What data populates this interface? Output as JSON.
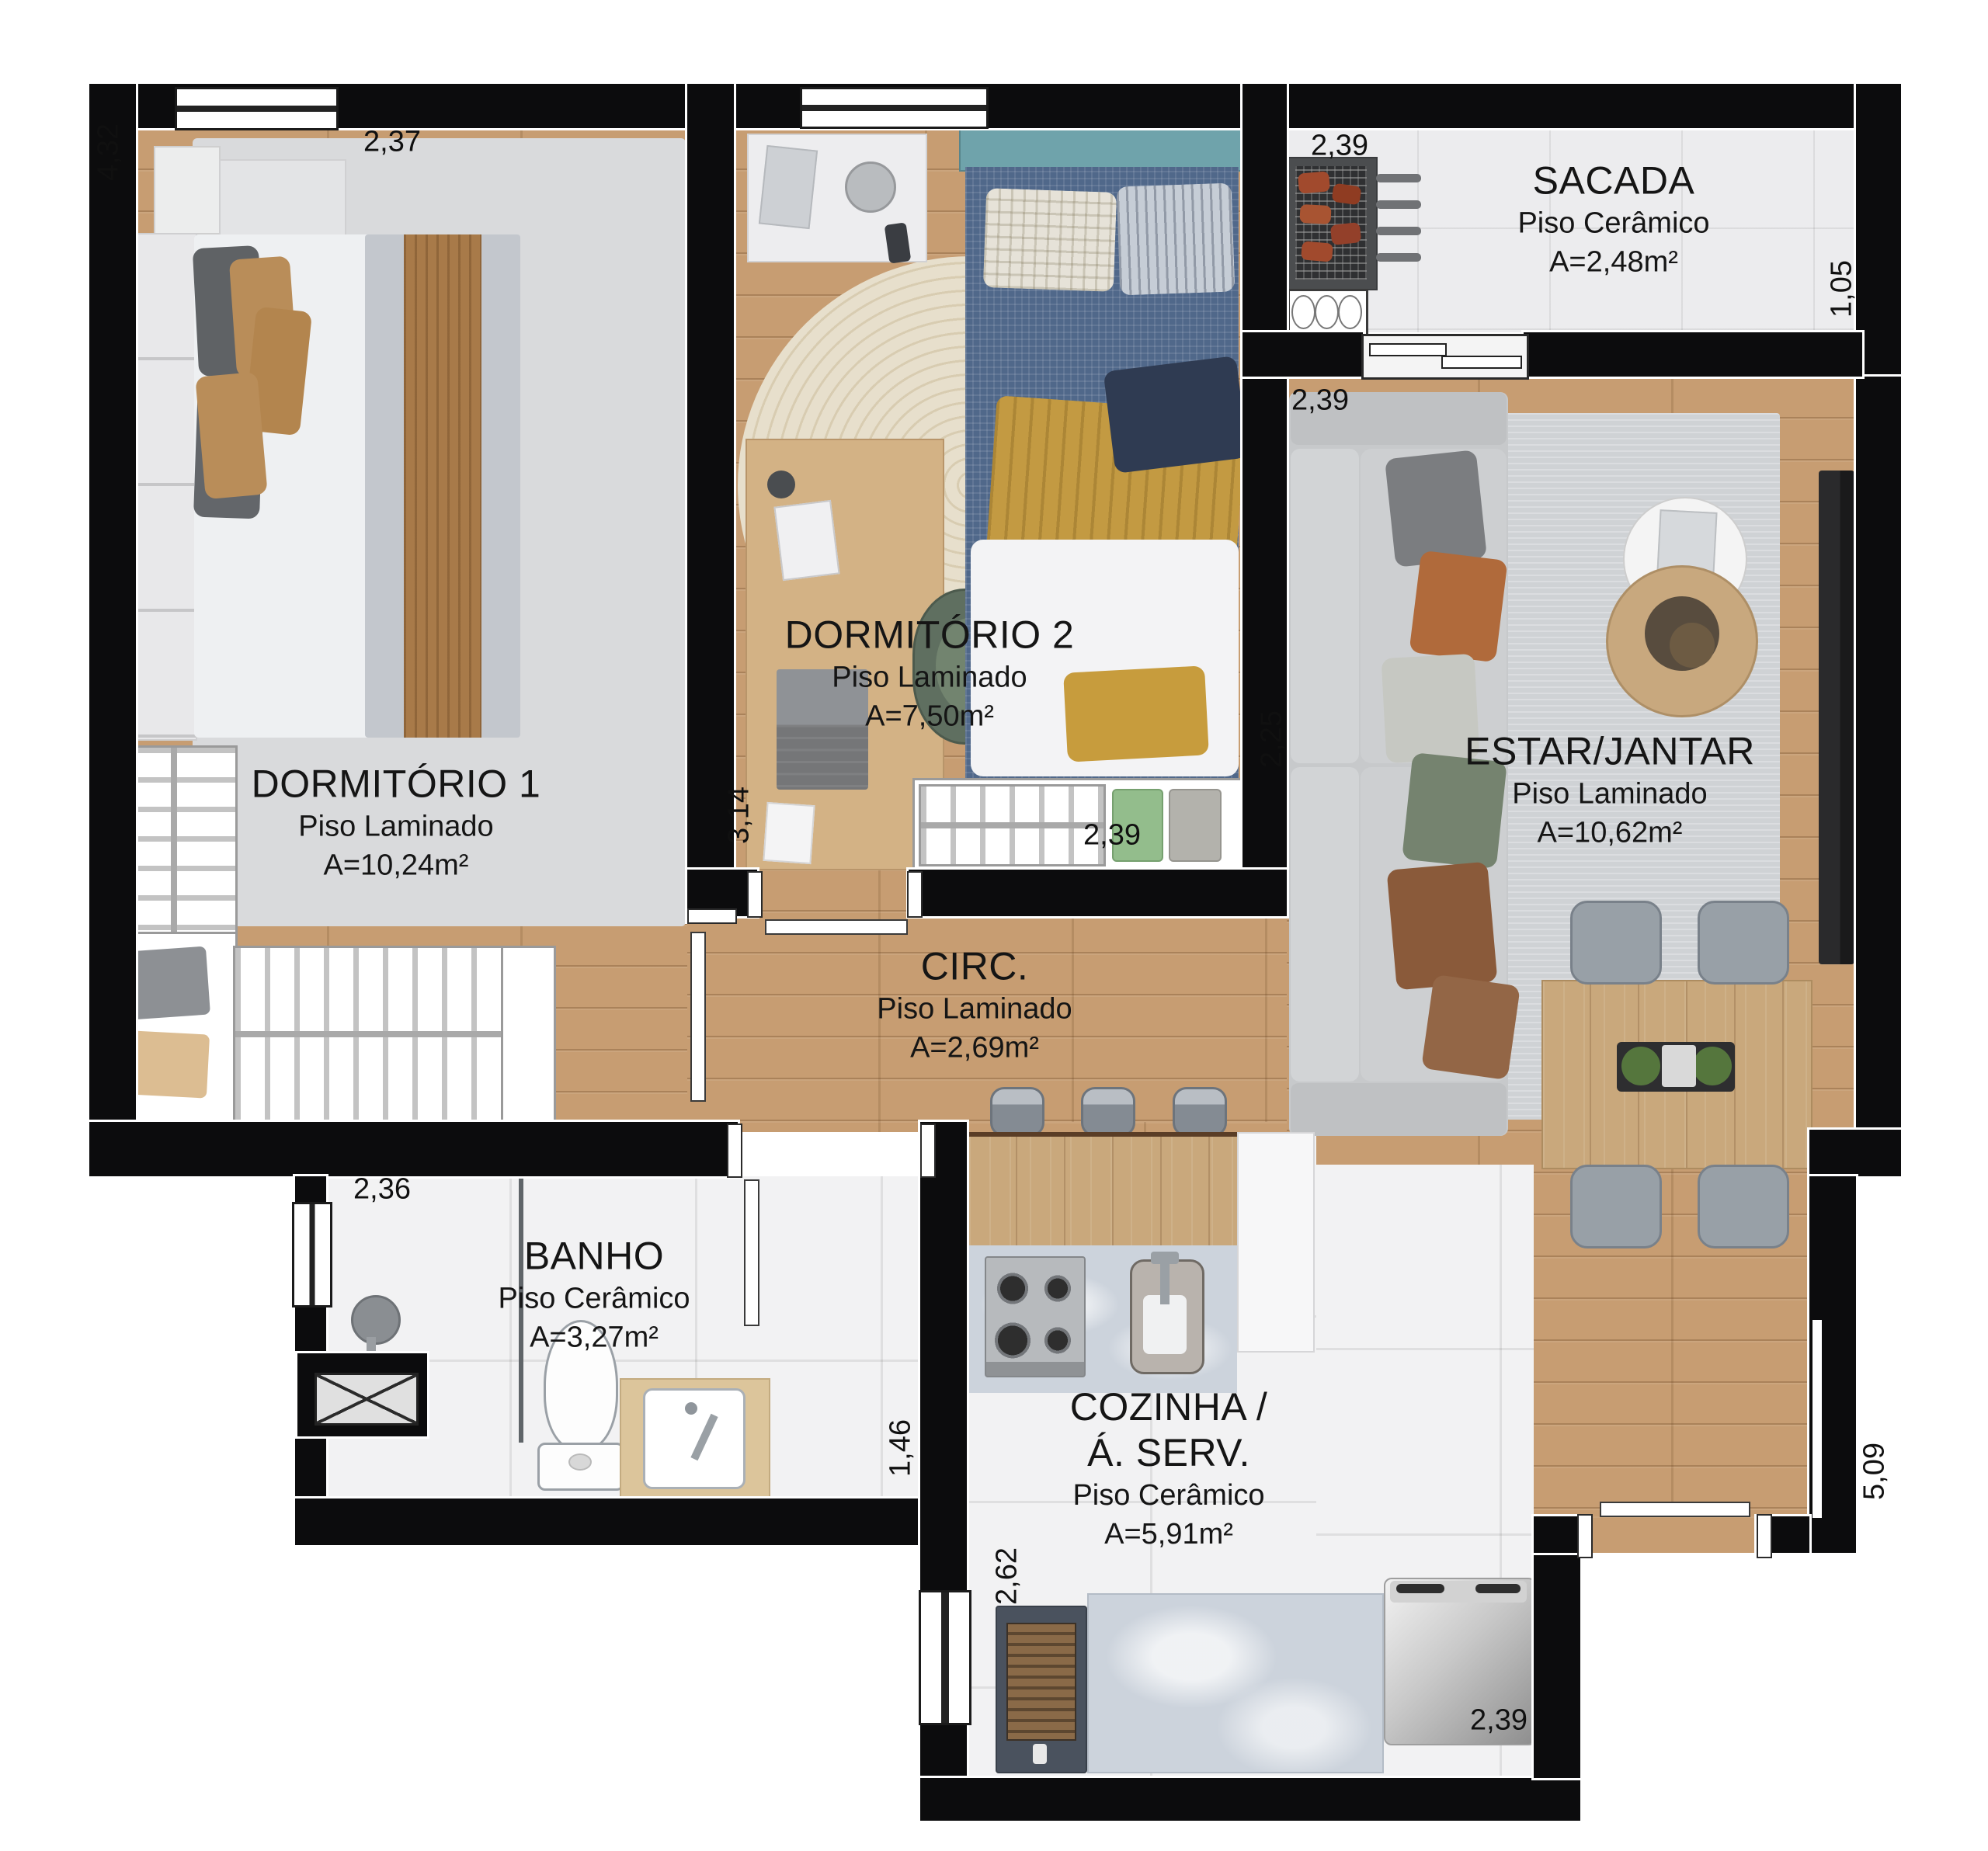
{
  "plan_title": "Apartment floor plan",
  "rooms": {
    "dorm1": {
      "name": "DORMITÓRIO 1",
      "floor": "Piso Laminado",
      "area": "A=10,24m²"
    },
    "dorm2": {
      "name": "DORMITÓRIO 2",
      "floor": "Piso Laminado",
      "area": "A=7,50m²"
    },
    "sacada": {
      "name": "SACADA",
      "floor": "Piso Cerâmico",
      "area": "A=2,48m²"
    },
    "estar": {
      "name": "ESTAR/JANTAR",
      "floor": "Piso Laminado",
      "area": "A=10,62m²"
    },
    "circ": {
      "name": "CIRC.",
      "floor": "Piso Laminado",
      "area": "A=2,69m²"
    },
    "banho": {
      "name": "BANHO",
      "floor": "Piso Cerâmico",
      "area": "A=3,27m²"
    },
    "cozinha": {
      "name_line1": "COZINHA /",
      "name_line2": "Á. SERV.",
      "floor": "Piso Cerâmico",
      "area": "A=5,91m²"
    }
  },
  "dims": [
    {
      "id": "dorm1-height",
      "text": "4,32"
    },
    {
      "id": "dorm1-width",
      "text": "2,37"
    },
    {
      "id": "sacada-width",
      "text": "2,39"
    },
    {
      "id": "sacada-depth",
      "text": "1,05"
    },
    {
      "id": "estar-width",
      "text": "2,39"
    },
    {
      "id": "estar-depth",
      "text": "2,25"
    },
    {
      "id": "dorm2-height",
      "text": "3,14"
    },
    {
      "id": "dorm2-width",
      "text": "2,39"
    },
    {
      "id": "banho-width",
      "text": "2,36"
    },
    {
      "id": "banho-depth",
      "text": "1,46"
    },
    {
      "id": "cozinha-height",
      "text": "2,62"
    },
    {
      "id": "cozinha-width",
      "text": "2,39"
    },
    {
      "id": "estar-side-height",
      "text": "5,09"
    }
  ],
  "colors": {
    "wall": "#0c0c0d",
    "laminate_floor": "#c79d72",
    "ceramic_floor": "#f2f2f3",
    "rug_gray": "#cfd2d5",
    "sofa_gray": "#c7c9cb",
    "bed_blue": "#50688a",
    "blanket_yellow": "#c39a42",
    "accent_wood": "#c9a87c"
  }
}
